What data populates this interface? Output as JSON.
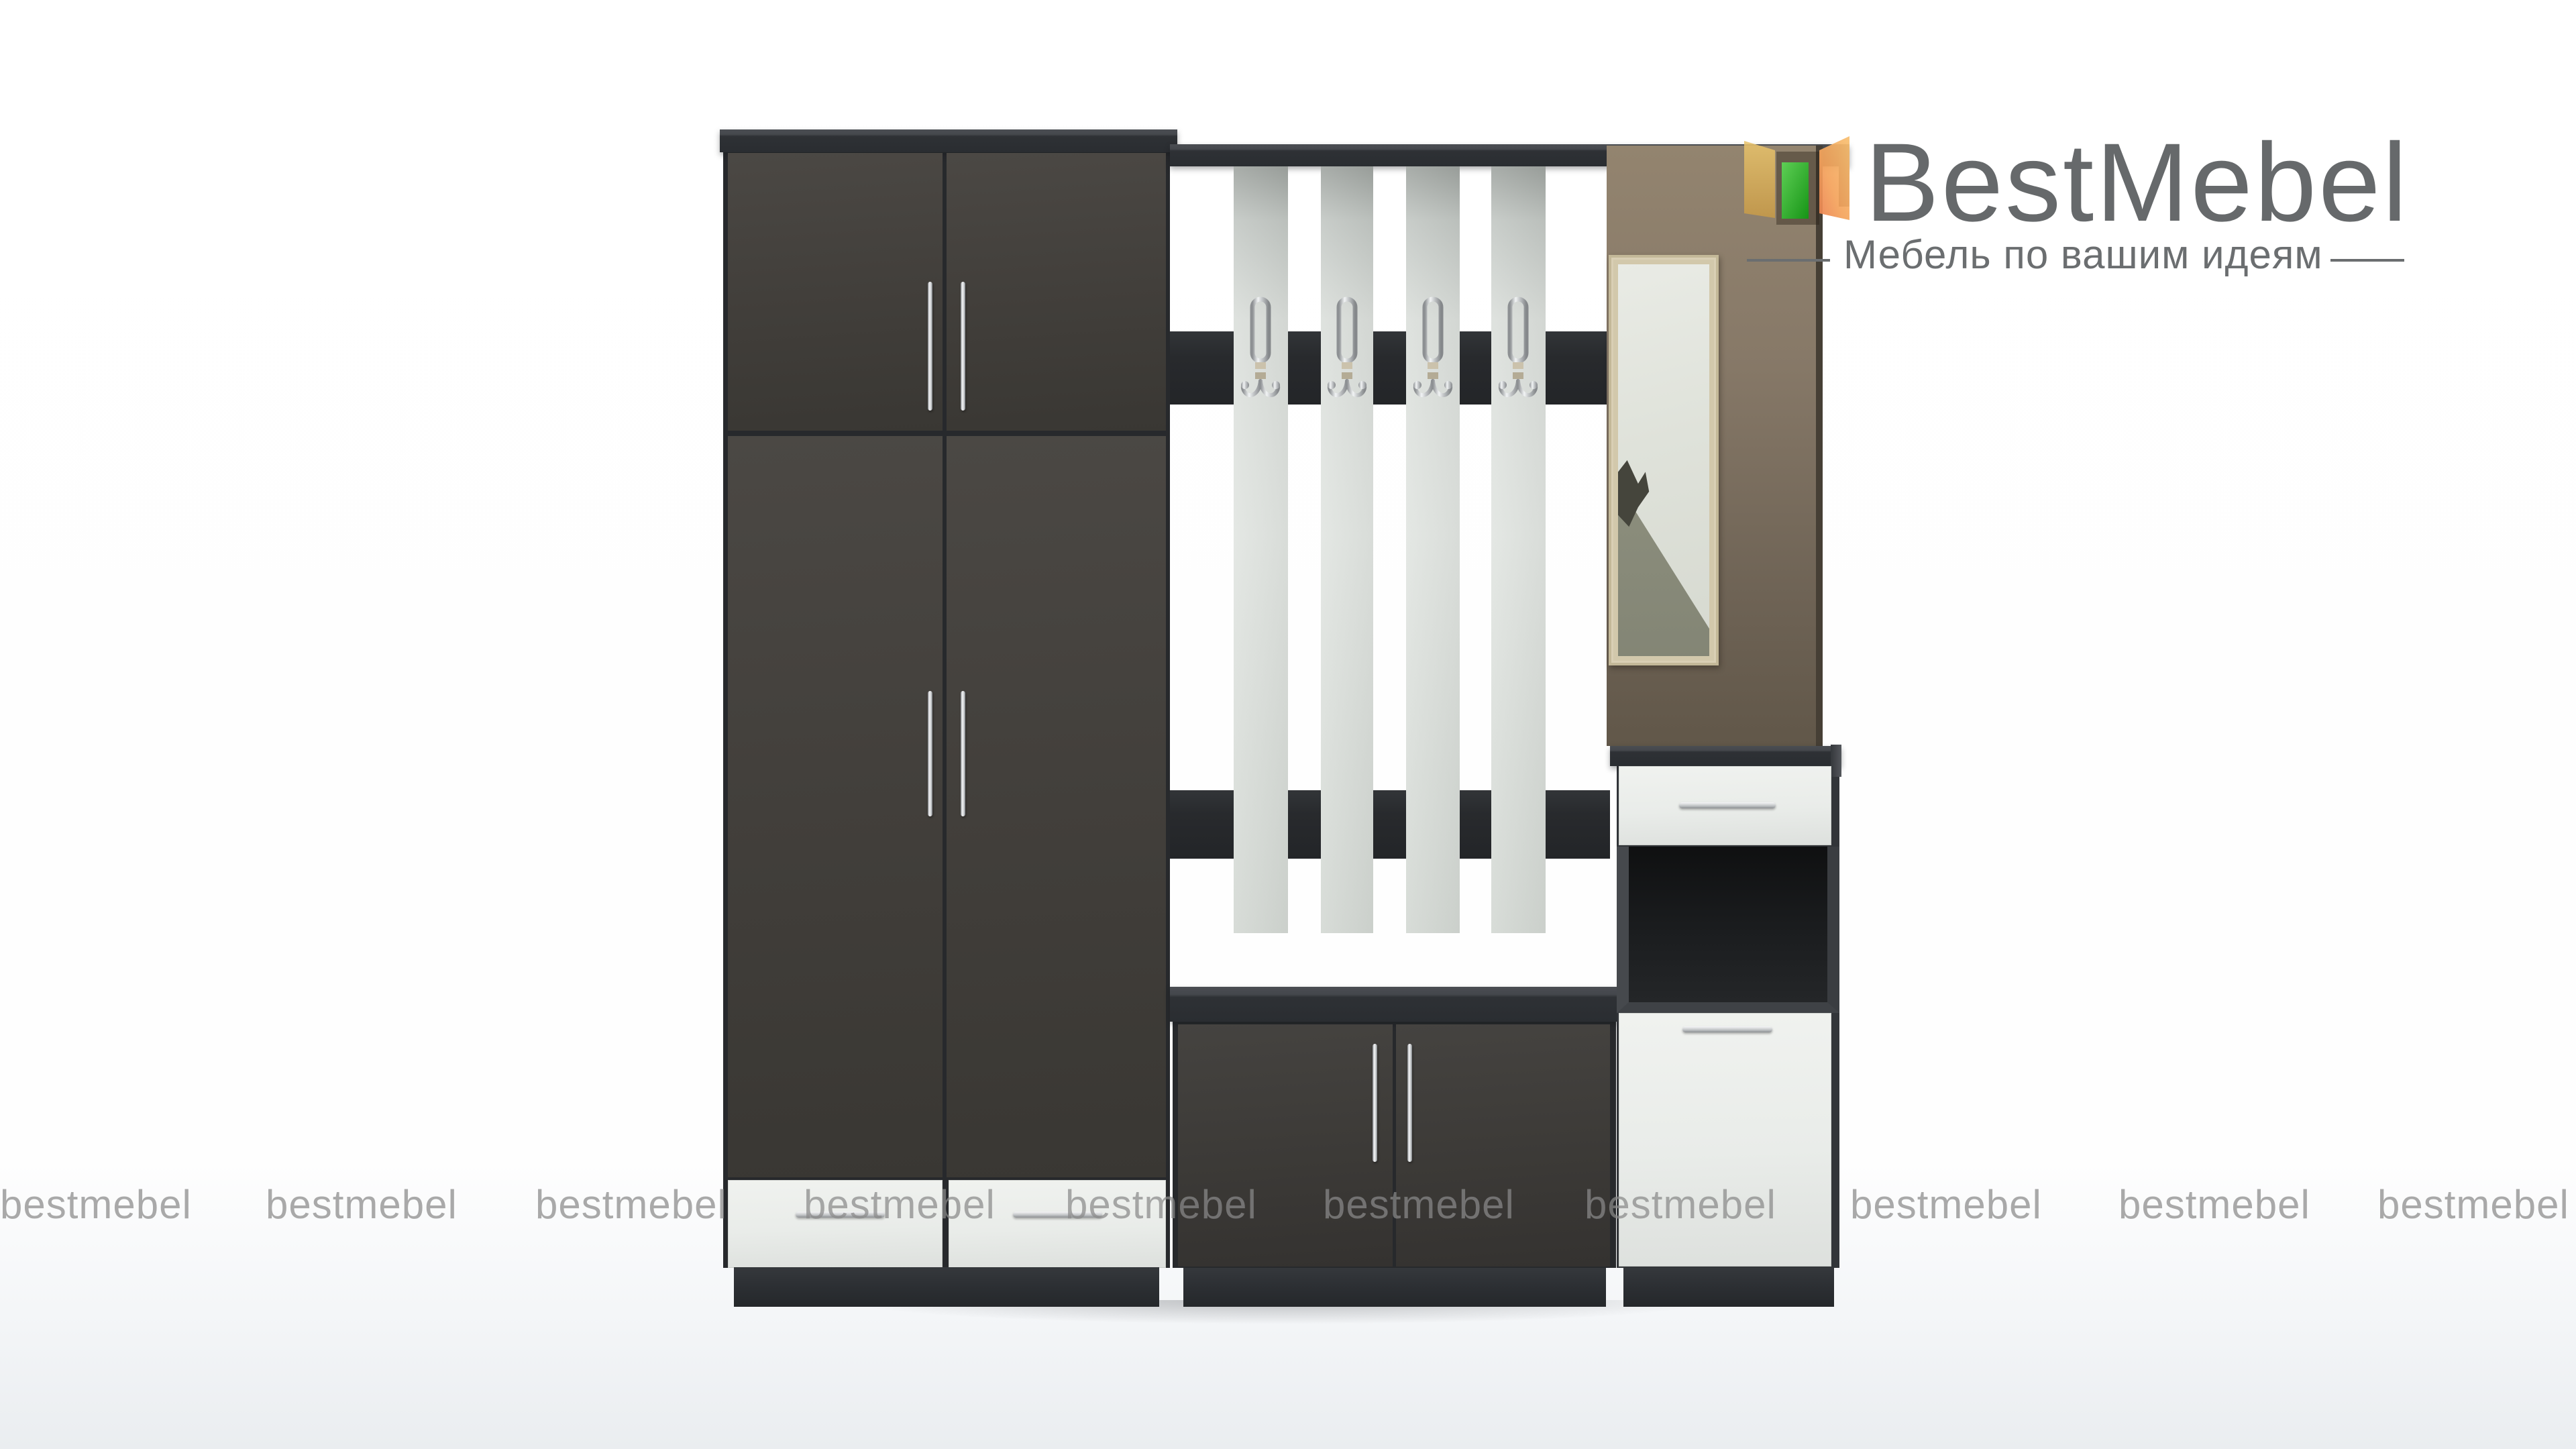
{
  "brand": {
    "name": "BestMebel",
    "tagline": "Мебель по вашим идеям",
    "text_color": "#66696b",
    "mark_colors": {
      "left_door": "#d8a851",
      "center_shelf": "#2fae2a",
      "right_door": "#f2a45c"
    }
  },
  "watermark": {
    "text": "bestmebel",
    "count": 10,
    "color": "#8a8a8a"
  },
  "scene": {
    "background_color": "#ffffff",
    "floor_color": "#eaedf0",
    "furniture_front_color": "#44413d",
    "furniture_carcass_color": "#2c2f33",
    "white_front_color": "#e9ece9",
    "slat_color": "#dfe3df",
    "mirror_panel_color": "#7e7160",
    "mirror_frame_color": "#d2c8ab",
    "hardware_finish": "chrome",
    "slats_count": 4,
    "hooks_count": 4
  }
}
